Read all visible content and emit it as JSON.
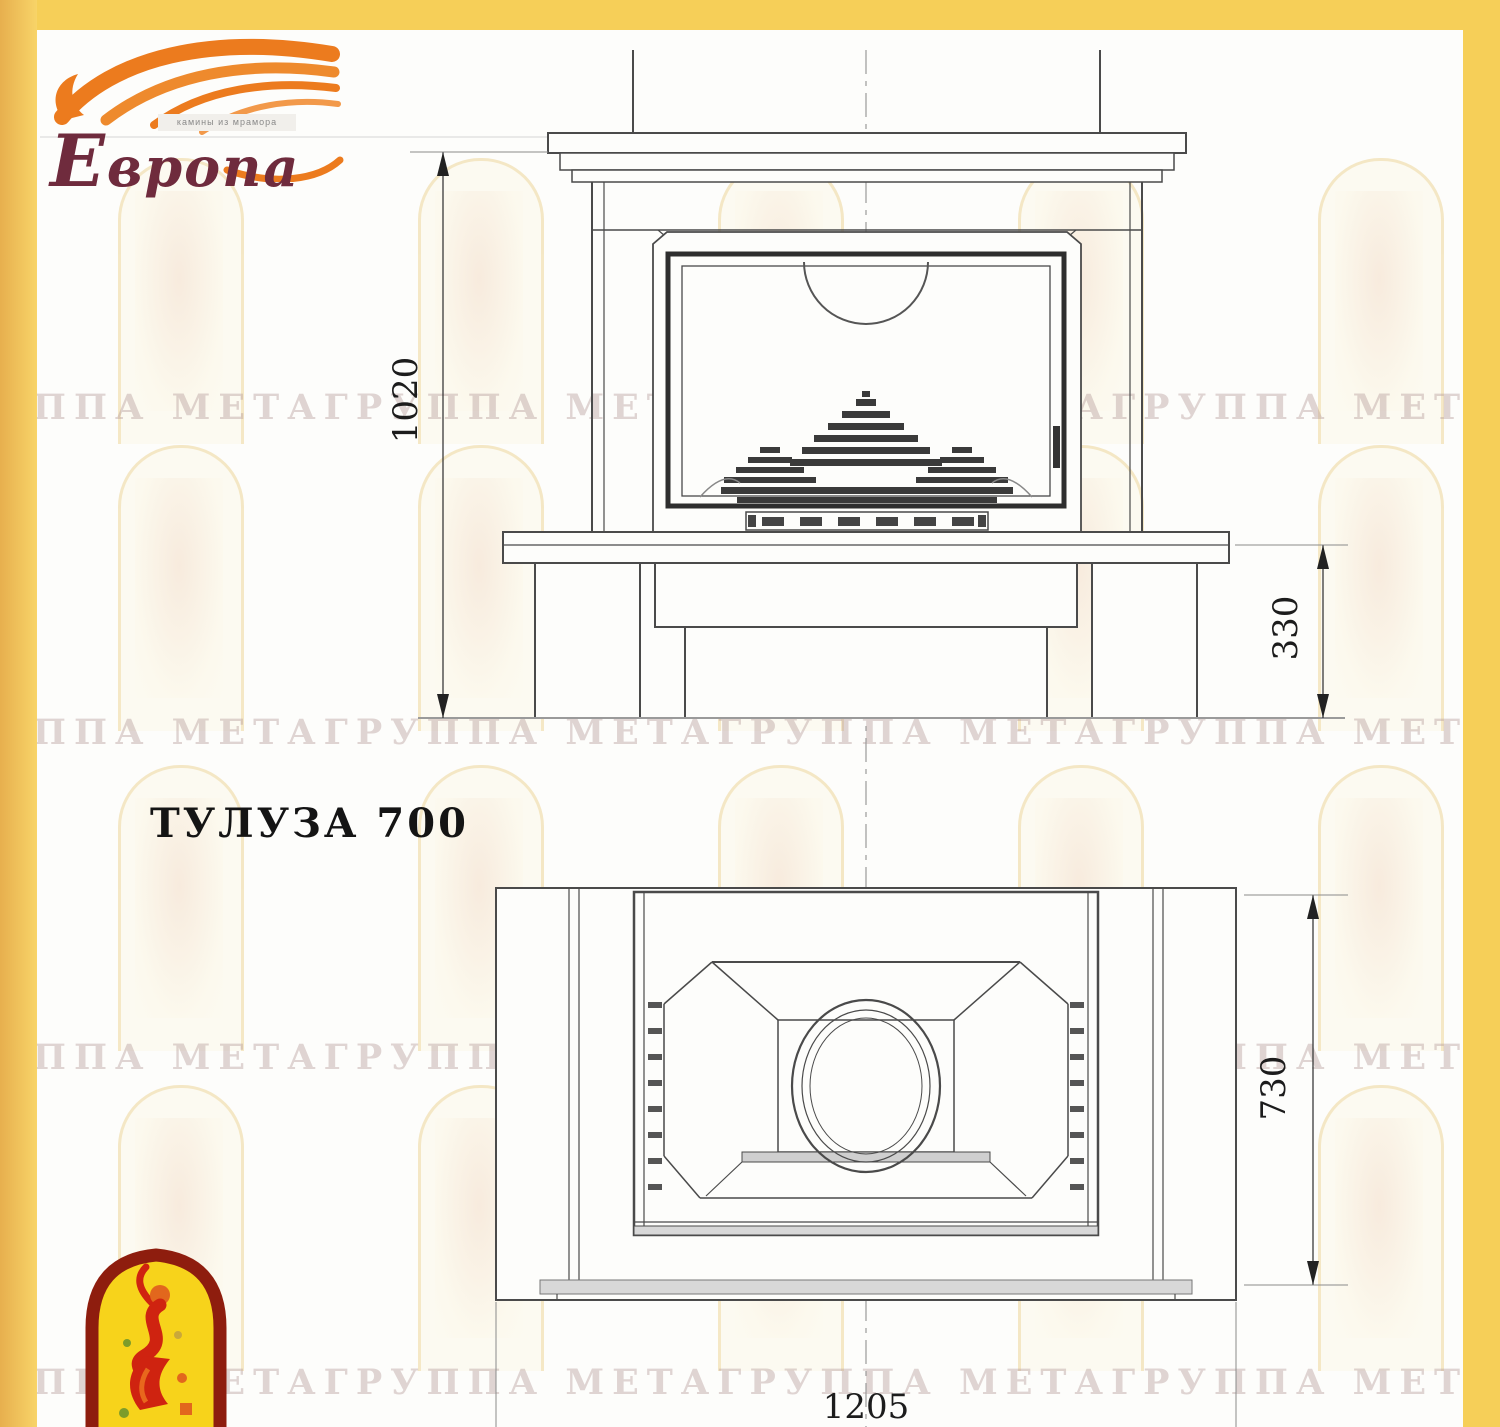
{
  "logo": {
    "brand": "Европа",
    "brand_initial": "Е",
    "brand_rest": "вропа",
    "tagline": "камины из мрамора"
  },
  "title": "ТУЛУЗА 700",
  "watermark": {
    "row": "ГРУППА МЕТАГРУППА МЕТАГРУППА МЕТАГРУППА МЕТА"
  },
  "drawing": {
    "views": {
      "front": "front elevation",
      "plan": "top plan view"
    },
    "dimensions": {
      "front_height": "1020",
      "base_height": "330",
      "plan_depth": "730",
      "plan_width": "1205"
    }
  },
  "colors": {
    "frame_yellow": "#f6cf58",
    "flame_orange": "#ec7b1e",
    "brand_maroon": "#6f2b3d",
    "emblem_border": "#8e1d0e",
    "emblem_yellow": "#f7d31b",
    "emblem_red": "#c42310",
    "line_gray": "#4a4a4a"
  }
}
